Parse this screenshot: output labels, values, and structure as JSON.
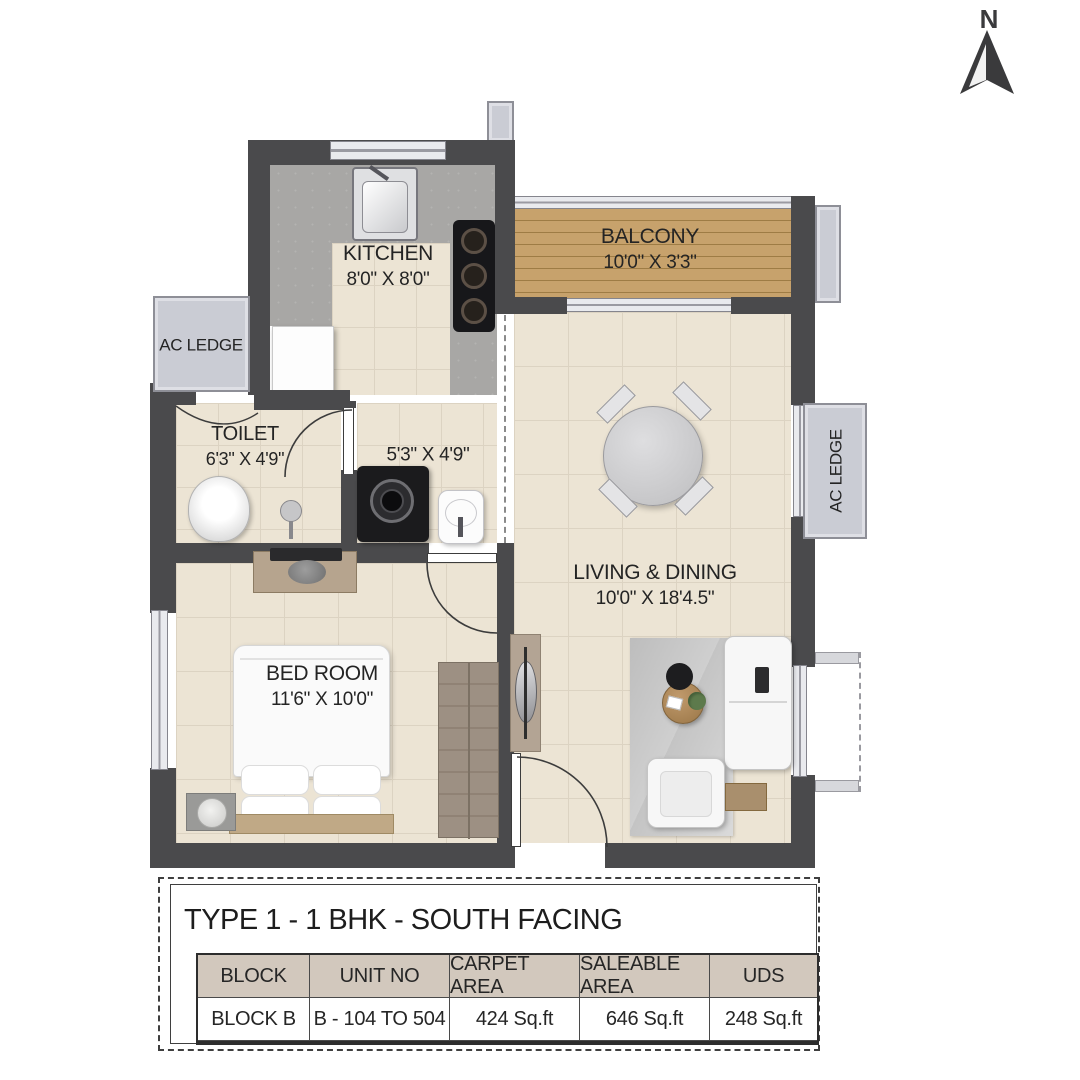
{
  "compass": {
    "north_label": "N"
  },
  "rooms": {
    "kitchen": {
      "name": "KITCHEN",
      "dims": "8'0\" X 8'0\""
    },
    "balcony": {
      "name": "BALCONY",
      "dims": "10'0\" X 3'3\""
    },
    "ac_ledge_left": {
      "name": "AC LEDGE"
    },
    "toilet": {
      "name": "TOILET",
      "dims": "6'3\" X 4'9\""
    },
    "utility": {
      "dims": "5'3\" X 4'9\""
    },
    "living": {
      "name": "LIVING & DINING",
      "dims": "10'0\" X 18'4.5\""
    },
    "bedroom": {
      "name": "BED ROOM",
      "dims": "11'6\" X 10'0\""
    },
    "ac_ledge_right": {
      "name": "AC LEDGE"
    }
  },
  "info": {
    "title": "TYPE 1 - 1 BHK - SOUTH FACING",
    "table": {
      "headers": [
        "BLOCK",
        "UNIT NO",
        "CARPET AREA",
        "SALEABLE AREA",
        "UDS"
      ],
      "row": [
        "BLOCK B",
        "B - 104 TO 504",
        "424 Sq.ft",
        "646 Sq.ft",
        "248 Sq.ft"
      ]
    }
  },
  "colors": {
    "wall": "#4a4a4c",
    "floor": "#ece4d4",
    "balcony_wood": "#c7a26c",
    "table_header_bg": "#d2c8bd",
    "ac_ledge": "#caccd4"
  }
}
